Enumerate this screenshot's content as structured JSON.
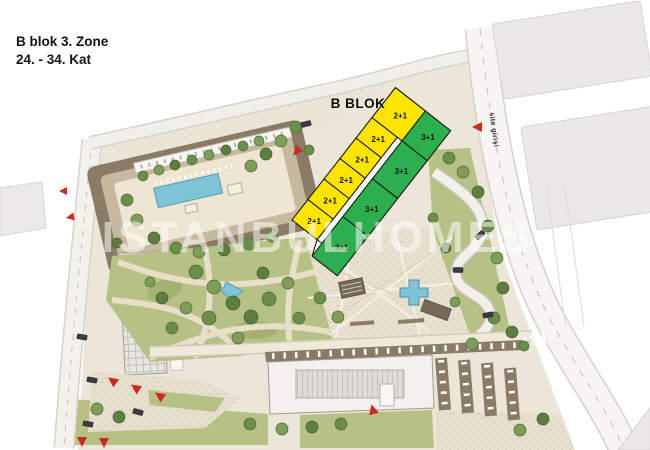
{
  "header": {
    "line1": "B blok 3. Zone",
    "line2": "24. - 34. Kat"
  },
  "site": {
    "block_label": "B BLOK",
    "entrance_label": "site girişi",
    "watermark": "ISTANBULHOMES",
    "colors": {
      "unit_yellow": "#ffe400",
      "unit_green": "#2daf4f",
      "entrance_red": "#cc2a1e",
      "pool_blue": "#7fc3d6"
    },
    "bblok": {
      "yellow_units": [
        {
          "label": "2+1"
        },
        {
          "label": "2+1"
        },
        {
          "label": "2+1"
        },
        {
          "label": "2+1"
        },
        {
          "label": "2+1"
        },
        {
          "label": "2+1"
        }
      ],
      "green_units": [
        {
          "label": "3+1"
        },
        {
          "label": "3+1"
        },
        {
          "label": "3+1"
        },
        {
          "label": "3+1"
        }
      ]
    }
  }
}
